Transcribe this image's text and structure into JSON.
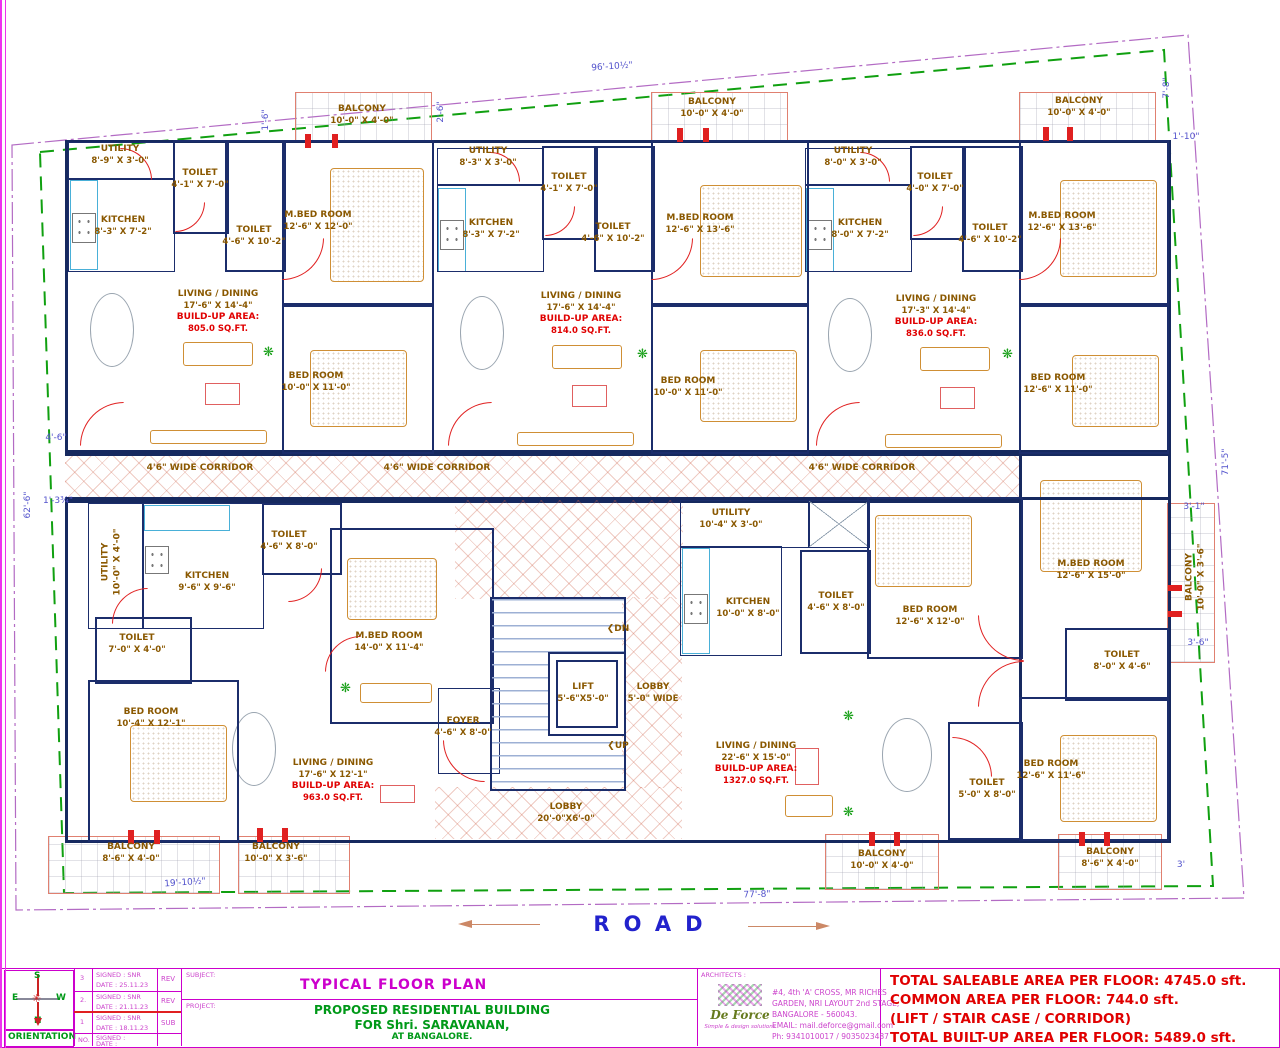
{
  "plan": {
    "corridor_label": "4'6\" WIDE CORRIDOR",
    "road": "ROAD",
    "stairs": {
      "arrow": "❮",
      "dn": "DN",
      "up": "UP"
    },
    "core": {
      "lift": {
        "name": "LIFT",
        "dims": "5'-6\"X5'-0\""
      },
      "lobby_side": {
        "name": "LOBBY",
        "dims": "5'-0\" WIDE"
      },
      "lobby_main": {
        "name": "LOBBY",
        "dims": "20'-0\"X6'-0\""
      },
      "foyer": {
        "name": "FOYER",
        "dims": "4'-6\" X 8'-0\""
      }
    },
    "unit_a": {
      "utility": {
        "name": "UTILITY",
        "dims": "8'-9\" X 3'-0\""
      },
      "toilet1": {
        "name": "TOILET",
        "dims": "4'-1\" X 7'-0\""
      },
      "kitchen": {
        "name": "KITCHEN",
        "dims": "8'-3\" X 7'-2\""
      },
      "toilet2": {
        "name": "TOILET",
        "dims": "4'-6\" X 10'-2\""
      },
      "mbed": {
        "name": "M.BED ROOM",
        "dims": "12'-6\" X 12'-0\""
      },
      "living": {
        "name": "LIVING / DINING",
        "dims": "17'-6\" X 14'-4\"",
        "bu_label": "BUILD-UP AREA:",
        "bu_value": "805.0 SQ.FT."
      },
      "bed": {
        "name": "BED ROOM",
        "dims": "10'-0\" X 11'-0\""
      },
      "balcony": {
        "name": "BALCONY",
        "dims": "10'-0\" X 4'-0\""
      }
    },
    "unit_b": {
      "utility": {
        "name": "UTILITY",
        "dims": "8'-3\" X 3'-0\""
      },
      "toilet1": {
        "name": "TOILET",
        "dims": "4'-1\" X 7'-0\""
      },
      "kitchen": {
        "name": "KITCHEN",
        "dims": "8'-3\" X 7'-2\""
      },
      "toilet2": {
        "name": "TOILET",
        "dims": "4'-6\" X 10'-2\""
      },
      "mbed": {
        "name": "M.BED ROOM",
        "dims": "12'-6\" X 13'-6\""
      },
      "living": {
        "name": "LIVING / DINING",
        "dims": "17'-6\" X 14'-4\"",
        "bu_label": "BUILD-UP AREA:",
        "bu_value": "814.0 SQ.FT."
      },
      "bed": {
        "name": "BED ROOM",
        "dims": "10'-0\" X 11'-0\""
      },
      "balcony": {
        "name": "BALCONY",
        "dims": "10'-0\" X 4'-0\""
      }
    },
    "unit_c": {
      "utility": {
        "name": "UTILITY",
        "dims": "8'-0\" X 3'-0\""
      },
      "toilet1": {
        "name": "TOILET",
        "dims": "4'-0\" X 7'-0\""
      },
      "kitchen": {
        "name": "KITCHEN",
        "dims": "8'-0\" X 7'-2\""
      },
      "toilet2": {
        "name": "TOILET",
        "dims": "4'-6\" X 10'-2\""
      },
      "mbed": {
        "name": "M.BED ROOM",
        "dims": "12'-6\" X 13'-6\""
      },
      "living": {
        "name": "LIVING / DINING",
        "dims": "17'-3\" X 14'-4\"",
        "bu_label": "BUILD-UP AREA:",
        "bu_value": "836.0 SQ.FT."
      },
      "bed": {
        "name": "BED ROOM",
        "dims": "12'-6\" X 11'-0\""
      },
      "balcony": {
        "name": "BALCONY",
        "dims": "10'-0\" X 4'-0\""
      }
    },
    "unit_d": {
      "utility": {
        "name": "UTILITY",
        "dims": "10'-0\" X 4'-0\""
      },
      "kitchen": {
        "name": "KITCHEN",
        "dims": "9'-6\" X 9'-6\""
      },
      "toilet1": {
        "name": "TOILET",
        "dims": "4'-6\" X 8'-0\""
      },
      "mbed": {
        "name": "M.BED ROOM",
        "dims": "14'-0\" X 11'-4\""
      },
      "toilet2": {
        "name": "TOILET",
        "dims": "7'-0\" X 4'-0\""
      },
      "bed": {
        "name": "BED ROOM",
        "dims": "10'-4\" X 12'-1\""
      },
      "living": {
        "name": "LIVING / DINING",
        "dims": "17'-6\" X 12'-1\"",
        "bu_label": "BUILD-UP AREA:",
        "bu_value": "963.0 SQ.FT."
      },
      "balcony1": {
        "name": "BALCONY",
        "dims": "8'-6\" X 4'-0\""
      },
      "balcony2": {
        "name": "BALCONY",
        "dims": "10'-0\" X 3'-6\""
      }
    },
    "unit_e": {
      "utility": {
        "name": "UTILITY",
        "dims": "10'-4\" X 3'-0\""
      },
      "kitchen": {
        "name": "KITCHEN",
        "dims": "10'-0\" X 8'-0\""
      },
      "toilet1": {
        "name": "TOILET",
        "dims": "4'-6\" X 8'-0\""
      },
      "bed1": {
        "name": "BED ROOM",
        "dims": "12'-6\" X 12'-0\""
      },
      "mbed": {
        "name": "M.BED ROOM",
        "dims": "12'-6\" X 15'-0\""
      },
      "toilet3": {
        "name": "TOILET",
        "dims": "8'-0\" X 4'-6\""
      },
      "living": {
        "name": "LIVING / DINING",
        "dims": "22'-6\" X 15'-0\"",
        "bu_label": "BUILD-UP AREA:",
        "bu_value": "1327.0 SQ.FT."
      },
      "toilet2": {
        "name": "TOILET",
        "dims": "5'-0\" X 8'-0\""
      },
      "bed2": {
        "name": "BED ROOM",
        "dims": "12'-6\" X 11'-6\""
      },
      "balcony_r": {
        "name": "BALCONY",
        "dims": "10'-0\" X 3'-6\""
      },
      "balcony1": {
        "name": "BALCONY",
        "dims": "10'-0\" X 4'-0\""
      },
      "balcony2": {
        "name": "BALCONY",
        "dims": "8'-6\" X 4'-0\""
      }
    }
  },
  "dims": {
    "top": "96'-10½\"",
    "left": "62'-6\"",
    "right": "71'-5\"",
    "bottom_left": "19'-10½\"",
    "bottom": "77'-8\"",
    "tr_v": "7'-8\"",
    "tr_h": "1'-10\"",
    "tl_1": "1'-6\"",
    "tl_2": "2'-6\"",
    "l_1": "4'-6\"",
    "l_2": "1'-3¾\"",
    "r_1": "3'-1\"",
    "r_2": "3'-6\"",
    "r_3": "3'"
  },
  "title_block": {
    "orientation_label": "ORIENTATION",
    "compass": {
      "n": "N",
      "s": "S",
      "e": "E",
      "w": "W"
    },
    "revisions": [
      {
        "no": "3",
        "signed": "SIGNED : SNR",
        "date": "DATE : 25.11.23",
        "status": "REV"
      },
      {
        "no": "2.",
        "signed": "SIGNED : SNR",
        "date": "DATE : 21.11.23",
        "status": "REV"
      },
      {
        "no": "1",
        "signed": "SIGNED : SNR",
        "date": "DATE : 18.11.23",
        "status": "SUB"
      },
      {
        "no": "NO.",
        "signed": "SIGNED :",
        "date": "DATE :",
        "status": ""
      }
    ],
    "subject_label": "SUBJECT:",
    "subject": "TYPICAL FLOOR PLAN",
    "project_label": "PROJECT:",
    "project_line1": "PROPOSED RESIDENTIAL BUILDING",
    "project_line2": "FOR Shri. SARAVANAN,",
    "project_line3": "AT BANGALORE.",
    "architects_label": "ARCHITECTS :",
    "firm_name": "De Force",
    "firm_tagline": "Simple & design solutions",
    "address_line1": "#4, 4th 'A' CROSS, MR RICHES",
    "address_line2": "GARDEN, NRI LAYOUT 2nd STAGE,",
    "address_line3": "BANGALORE - 560043.",
    "address_line4": "EMAIL: mail.deforce@gmail.com",
    "address_line5": "Ph: 9341010017 / 9035023487"
  },
  "totals": {
    "line1": "TOTAL SALEABLE AREA PER FLOOR: 4745.0 sft.",
    "line2": "COMMON AREA PER FLOOR: 744.0 sft.",
    "line3": "(LIFT / STAIR CASE / CORRIDOR)",
    "line4": "TOTAL BUILT-UP AREA PER FLOOR: 5489.0 sft."
  },
  "colors": {
    "wall_navy": "#1b2d6b",
    "label_brown": "#8a5800",
    "area_red": "#e00000",
    "dim_blue": "#5353cc",
    "boundary_green": "#10a010",
    "boundary_purple": "#b36bc4",
    "title_magenta": "#cc00cc",
    "title_green": "#009918",
    "road_blue": "#2222cc"
  }
}
